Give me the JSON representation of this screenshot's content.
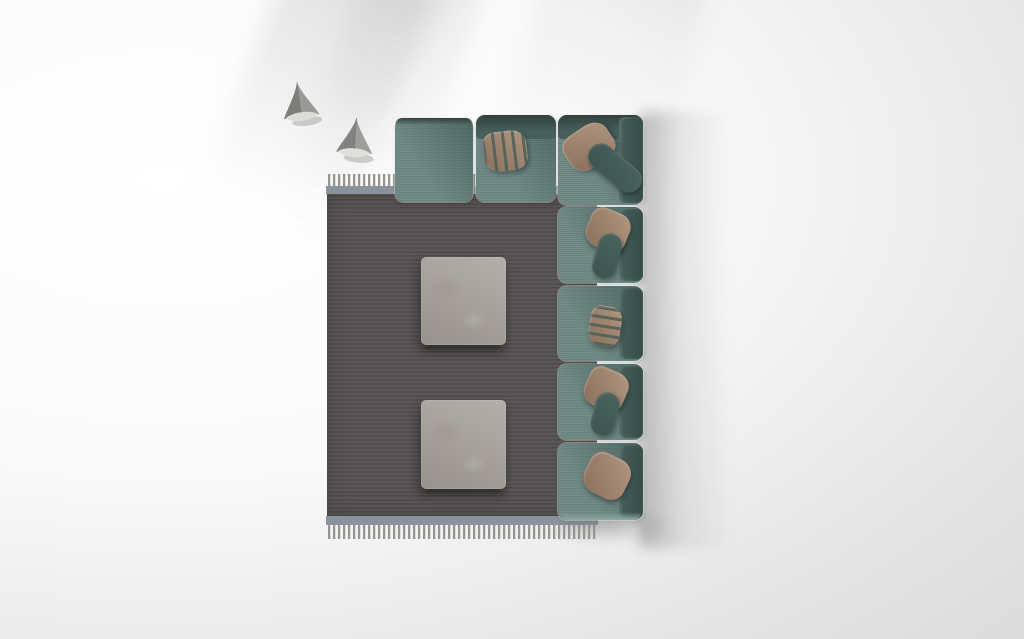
{
  "meta": {
    "title": "Top view 3D render: corner sofa with rug, coffee tables and decor",
    "canvas_width": "1024",
    "canvas_height": "639"
  },
  "colors": {
    "bg-shade": "#d5d5d5",
    "sofa-fabric": "#5e7b76",
    "sofa-back": "#47605c",
    "sofa-dark-top": "#31403d",
    "sofa-bolster": "#3d5450",
    "pillow-tan": "#b0977f",
    "pillow-tan-dark": "#8a6f5c",
    "rug-body": "#575252",
    "rug-border": "#8a929d",
    "rug-fringe": "#96948f",
    "table-stone": "#a8a29a",
    "decor-gray": "#8f8e8a",
    "decor-base": "#dcdbd5"
  },
  "objects": {
    "sofa": {
      "label": "teal modular corner sofa, top view",
      "top_modules": 3,
      "side_seats": 4,
      "throw_pillows": 6
    },
    "rug": {
      "label": "dark gray fringed area rug with blue-gray border"
    },
    "table_1": {
      "label": "square stone coffee table"
    },
    "table_2": {
      "label": "square stone coffee table"
    },
    "decor_1": {
      "label": "gray origami-style decor object"
    },
    "decor_2": {
      "label": "gray origami-style decor object"
    }
  }
}
